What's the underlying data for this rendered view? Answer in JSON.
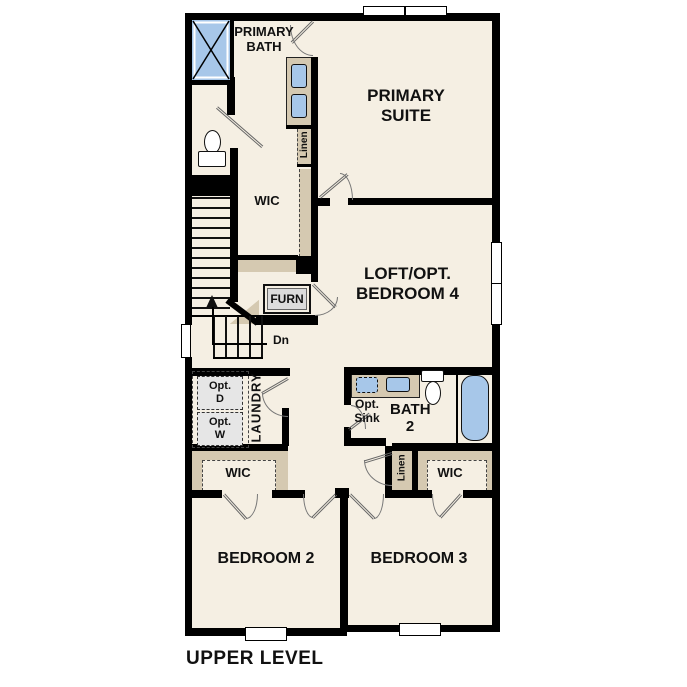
{
  "title": "UPPER LEVEL",
  "colors": {
    "background": "#FFFFFF",
    "floor": "#F5EFE3",
    "wall": "#000000",
    "cabinetry": "#D5C9B1",
    "fixtures": "#A7C7E9",
    "optional_appliance": "#E6E6E6"
  },
  "rooms": {
    "primary_bath": {
      "label": "PRIMARY\nBATH"
    },
    "primary_suite": {
      "label": "PRIMARY\nSUITE"
    },
    "primary_wic": {
      "label": "WIC"
    },
    "primary_linen": {
      "label": "Linen"
    },
    "loft": {
      "label": "LOFT/OPT.\nBEDROOM 4"
    },
    "furnace": {
      "label": "FURN"
    },
    "laundry": {
      "label": "LAUNDRY"
    },
    "bath2": {
      "label": "BATH\n2"
    },
    "hall_linen": {
      "label": "Linen"
    },
    "bedroom2_wic": {
      "label": "WIC"
    },
    "bedroom3_wic": {
      "label": "WIC"
    },
    "bedroom2": {
      "label": "BEDROOM 2"
    },
    "bedroom3": {
      "label": "BEDROOM 3"
    }
  },
  "annotations": {
    "stairs_direction": "Dn",
    "optional_dryer": "Opt.\nD",
    "optional_washer": "Opt.\nW",
    "optional_sink": "Opt.\nSink"
  }
}
